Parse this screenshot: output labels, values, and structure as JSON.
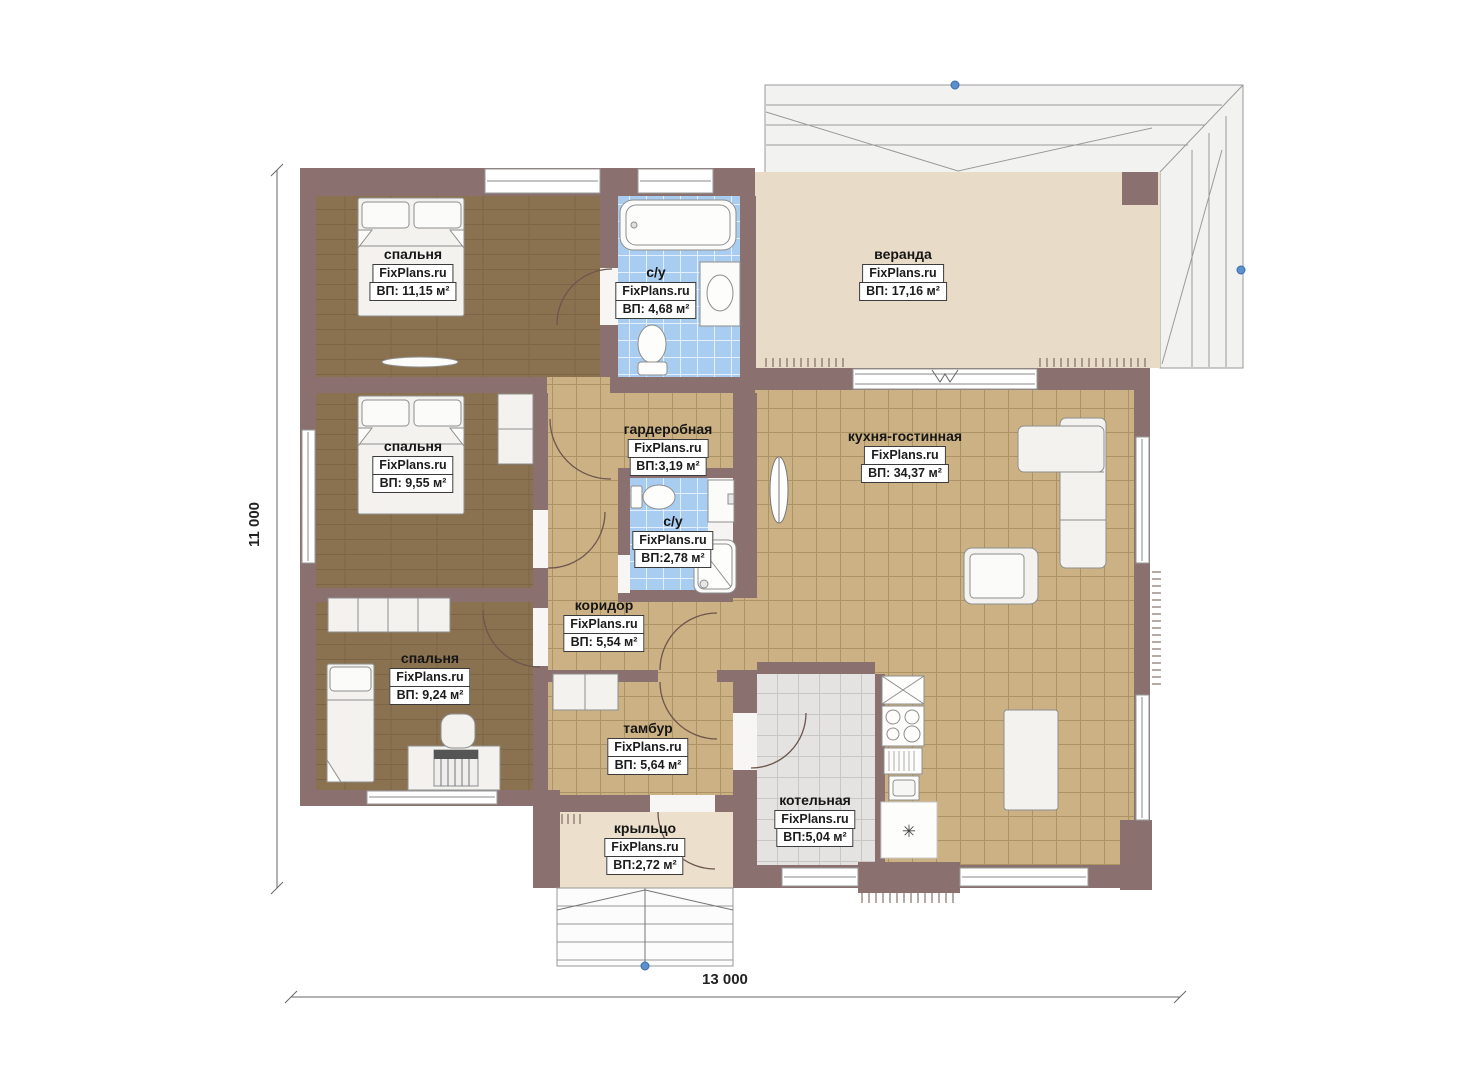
{
  "branding": {
    "watermark": "FixPlans.ru"
  },
  "dimensions": {
    "vertical": "11 000",
    "horizontal": "13 000"
  },
  "symbols": {
    "boiler_unit": "✳"
  },
  "rooms": [
    {
      "id": "bedroom-1",
      "name": "спальня",
      "area": "ВП: 11,15 м²"
    },
    {
      "id": "bath-1",
      "name": "с/у",
      "area": "ВП: 4,68 м²"
    },
    {
      "id": "veranda",
      "name": "веранда",
      "area": "ВП: 17,16 м²"
    },
    {
      "id": "bedroom-2",
      "name": "спальня",
      "area": "ВП: 9,55 м²"
    },
    {
      "id": "wardrobe",
      "name": "гардеробная",
      "area": "ВП:3,19 м²"
    },
    {
      "id": "bath-2",
      "name": "с/у",
      "area": "ВП:2,78 м²"
    },
    {
      "id": "kitchen",
      "name": "кухня-гостинная",
      "area": "ВП: 34,37 м²"
    },
    {
      "id": "corridor",
      "name": "коридор",
      "area": "ВП: 5,54 м²"
    },
    {
      "id": "bedroom-3",
      "name": "спальня",
      "area": "ВП: 9,24 м²"
    },
    {
      "id": "tambour",
      "name": "тамбур",
      "area": "ВП: 5,64 м²"
    },
    {
      "id": "boiler",
      "name": "котельная",
      "area": "ВП:5,04 м²"
    },
    {
      "id": "porch",
      "name": "крыльцо",
      "area": "ВП:2,72 м²"
    }
  ],
  "colors": {
    "wall": "#8a7170",
    "bedroom_floor": "#8a7150",
    "tile_floor": "#cbb183",
    "bath_floor": "#a9cdf0",
    "veranda_floor": "#e8dbc8",
    "porch_floor": "#ecdfcc",
    "boiler_floor": "#e4e3e1",
    "roof": "#f2f2f1",
    "marker_dot": "#5b8fd0"
  }
}
